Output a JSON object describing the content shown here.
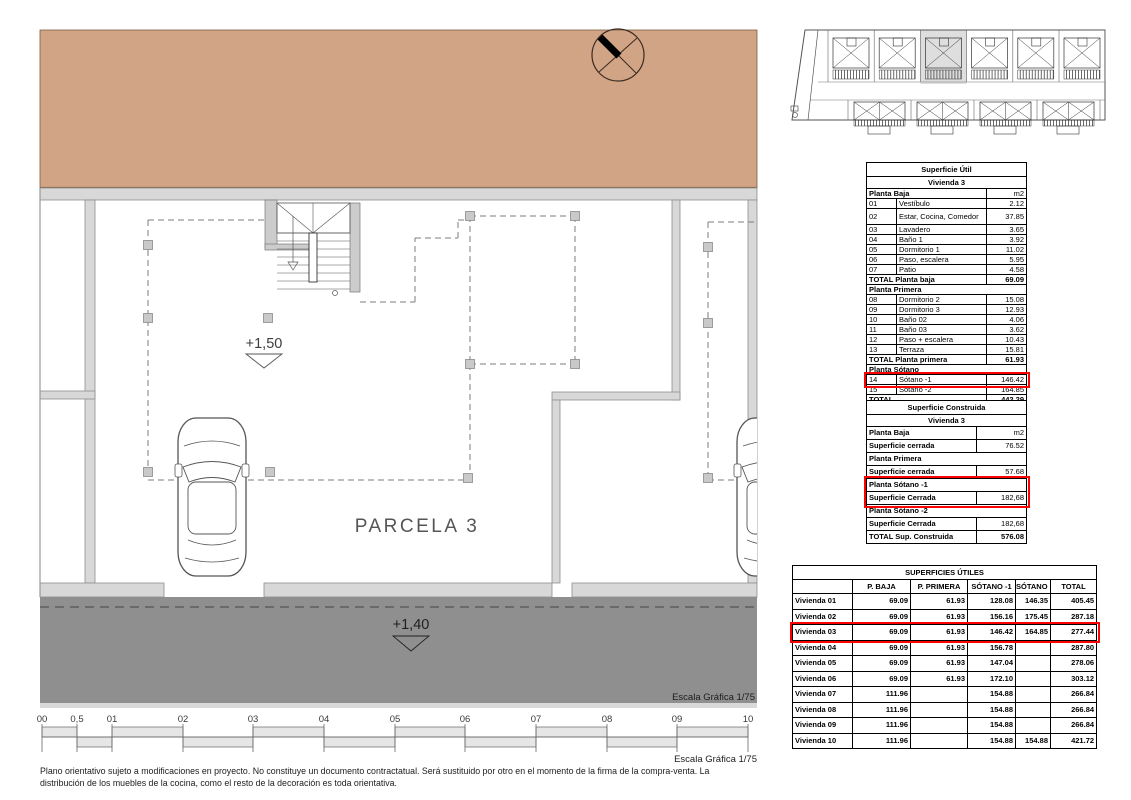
{
  "plan": {
    "parcel_label": "PARCELA 3",
    "level_upper": "+1,50",
    "level_road": "+1,40",
    "escala_band": "Escala Gráfica 1/75",
    "scale_bar": {
      "labels": [
        "00",
        "0,5",
        "01",
        "02",
        "03",
        "04",
        "05",
        "06",
        "07",
        "08",
        "09",
        "10"
      ]
    }
  },
  "tables": {
    "util": {
      "title": "Superficie Útil",
      "subtitle": "Vivienda 3",
      "rows": [
        {
          "kind": "head",
          "label": "Planta Baja",
          "value": "m2"
        },
        {
          "kind": "item",
          "num": "01",
          "label": "Vestíbulo",
          "value": "2.12"
        },
        {
          "kind": "item",
          "num": "02",
          "label": "Estar, Cocina, Comedor",
          "value": "37.85",
          "tall": true
        },
        {
          "kind": "item",
          "num": "03",
          "label": "Lavadero",
          "value": "3.65"
        },
        {
          "kind": "item",
          "num": "04",
          "label": "Baño 1",
          "value": "3.92"
        },
        {
          "kind": "item",
          "num": "05",
          "label": "Dormitorio 1",
          "value": "11.02"
        },
        {
          "kind": "item",
          "num": "06",
          "label": "Paso, escalera",
          "value": "5.95"
        },
        {
          "kind": "item",
          "num": "07",
          "label": "Patio",
          "value": "4.58"
        },
        {
          "kind": "total",
          "label": "TOTAL Planta baja",
          "value": "69.09"
        },
        {
          "kind": "section",
          "label": "Planta Primera"
        },
        {
          "kind": "item",
          "num": "08",
          "label": "Dormitorio 2",
          "value": "15.08"
        },
        {
          "kind": "item",
          "num": "09",
          "label": "Dormitorio 3",
          "value": "12.93"
        },
        {
          "kind": "item",
          "num": "10",
          "label": "Baño 02",
          "value": "4.06"
        },
        {
          "kind": "item",
          "num": "11",
          "label": "Baño 03",
          "value": "3.62"
        },
        {
          "kind": "item",
          "num": "12",
          "label": "Paso + escalera",
          "value": "10.43"
        },
        {
          "kind": "item",
          "num": "13",
          "label": "Terraza",
          "value": "15.81"
        },
        {
          "kind": "total",
          "label": "TOTAL Planta primera",
          "value": "61.93"
        },
        {
          "kind": "section",
          "label": "Planta Sótano"
        },
        {
          "kind": "item",
          "num": "14",
          "label": "Sótano -1",
          "value": "146.42",
          "hl": "u1"
        },
        {
          "kind": "item",
          "num": "15",
          "label": "Sótano -2",
          "value": "164.85"
        },
        {
          "kind": "total",
          "label": "TOTAL",
          "value": "442.29"
        }
      ]
    },
    "construida": {
      "title": "Superficie Construida",
      "subtitle": "Vivienda 3",
      "rows": [
        {
          "kind": "head",
          "label": "Planta Baja",
          "value": "m2"
        },
        {
          "kind": "item",
          "label": "Superficie cerrada",
          "value": "76.52"
        },
        {
          "kind": "section",
          "label": "Planta Primera"
        },
        {
          "kind": "item",
          "label": "Superficie cerrada",
          "value": "57.68"
        },
        {
          "kind": "section",
          "label": "Planta Sótano -1",
          "hl": "c1"
        },
        {
          "kind": "item",
          "label": "Superficie Cerrada",
          "value": "182,68",
          "hl": "c1"
        },
        {
          "kind": "section",
          "label": "Planta Sótano -2"
        },
        {
          "kind": "item",
          "label": "Superficie Cerrada",
          "value": "182,68"
        },
        {
          "kind": "total",
          "label": "TOTAL Sup. Construida",
          "value": "576.08"
        }
      ]
    },
    "superficies_utiles": {
      "title": "SUPERFICIES ÚTILES",
      "columns": [
        "",
        "P. BAJA",
        "P. PRIMERA",
        "SÓTANO -1",
        "SÓTANO -2",
        "TOTAL"
      ],
      "rows": [
        {
          "name": "Vivienda 01",
          "values": [
            "69.09",
            "61.93",
            "128.08",
            "146.35",
            "405.45"
          ]
        },
        {
          "name": "Vivienda 02",
          "values": [
            "69.09",
            "61.93",
            "156.16",
            "175.45",
            "287.18"
          ]
        },
        {
          "name": "Vivienda 03",
          "values": [
            "69.09",
            "61.93",
            "146.42",
            "164.85",
            "277.44"
          ],
          "hl": "b1"
        },
        {
          "name": "Vivienda 04",
          "values": [
            "69.09",
            "61.93",
            "156.78",
            "",
            "287.80"
          ]
        },
        {
          "name": "Vivienda 05",
          "values": [
            "69.09",
            "61.93",
            "147.04",
            "",
            "278.06"
          ]
        },
        {
          "name": "Vivienda 06",
          "values": [
            "69.09",
            "61.93",
            "172.10",
            "",
            "303.12"
          ]
        },
        {
          "name": "Vivienda 07",
          "values": [
            "111.96",
            "",
            "154.88",
            "",
            "266.84"
          ]
        },
        {
          "name": "Vivienda 08",
          "values": [
            "111.96",
            "",
            "154.88",
            "",
            "266.84"
          ]
        },
        {
          "name": "Vivienda 09",
          "values": [
            "111.96",
            "",
            "154.88",
            "",
            "266.84"
          ]
        },
        {
          "name": "Vivienda 10",
          "values": [
            "111.96",
            "",
            "154.88",
            "154.88",
            "421.72"
          ]
        }
      ]
    }
  },
  "footer": {
    "scale_label": "Escala Gráfica 1/75",
    "disclaimer_lines": [
      "Plano orientativo sujeto a modificaciones en proyecto. No constituye un documento contractatual. Será sustituido por otro en el momento de la firma de la compra-venta. La",
      "distribución de los muebles de la cocina, como el resto de la decoración es toda orientativa."
    ]
  },
  "colors": {
    "terrain": "#d1a485",
    "road": "#8f8f8f",
    "wall": "#d8d8d8",
    "highlight_red": "#ff0000"
  }
}
